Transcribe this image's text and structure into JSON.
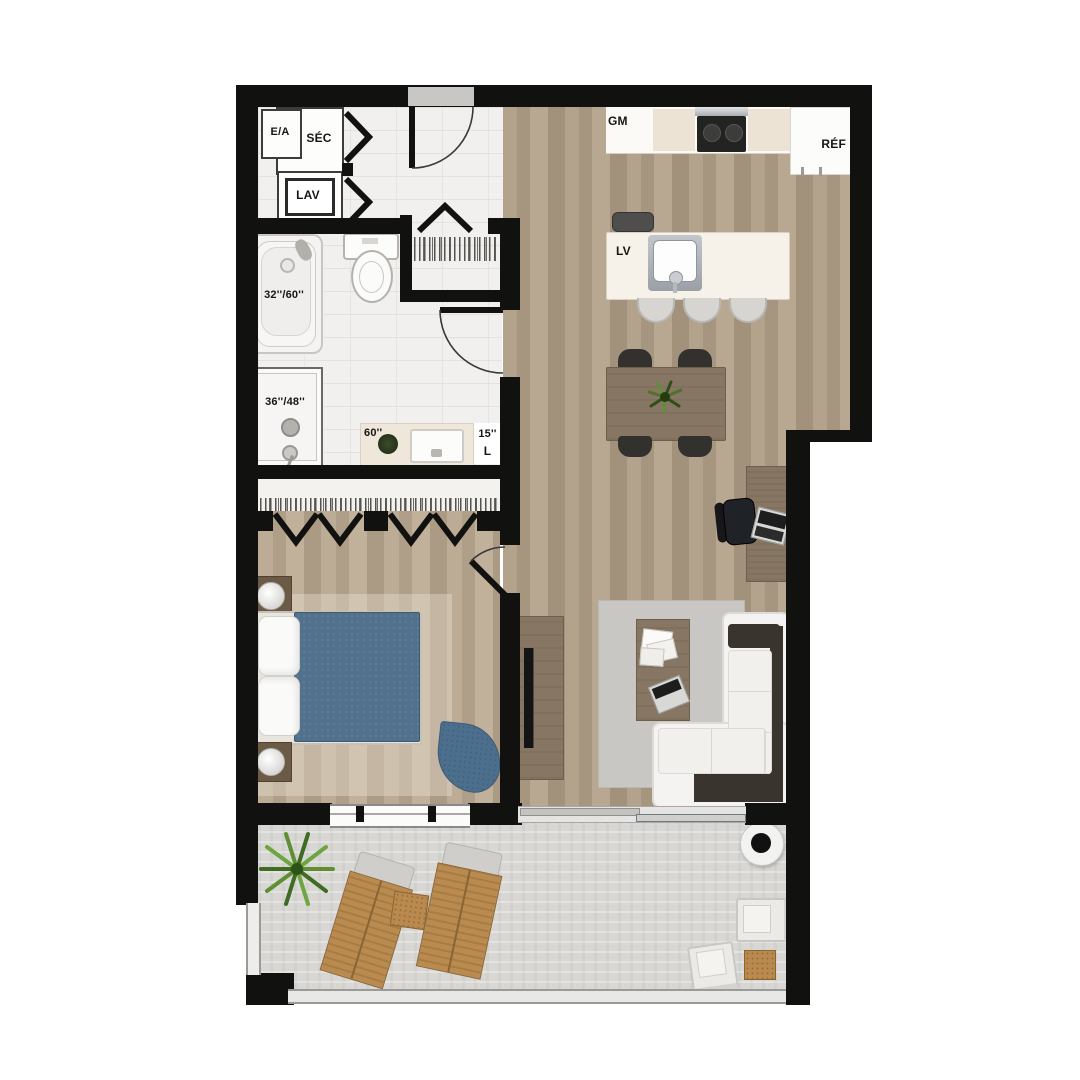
{
  "plan_title": "apartment-unit-floor-plan",
  "labels": {
    "laundry": {
      "air_exchanger": "E/A",
      "dryer": "SÉC",
      "washer": "LAV"
    },
    "bathroom": {
      "bathtub_size": "32''/60''",
      "shower_size": "36''/48''",
      "vanity_size": "60''",
      "linen_size": "15''",
      "linen": "L"
    },
    "kitchen": {
      "pantry": "GM",
      "fridge": "RÉF",
      "dishwasher": "LV"
    }
  },
  "palette": {
    "wall": "#111110",
    "wood_floor": "#ab9a84",
    "bedroom_floor": "#b5a58f",
    "tile_floor": "#f1f0ee",
    "balcony_concrete": "#d8d7d4",
    "counter_white": "#fbfaf7",
    "counter_beige": "#ece3d4",
    "furniture_brown": "#877663",
    "sofa_white": "#f4f3f1",
    "sofa_dark": "#39342d",
    "bed_blue": "#52718c",
    "accent_chair_blue": "#4c6f8e",
    "rug_gray": "#c8c6c2",
    "lounger_tan": "#b98b50",
    "plant_green": "#5f8f34"
  }
}
